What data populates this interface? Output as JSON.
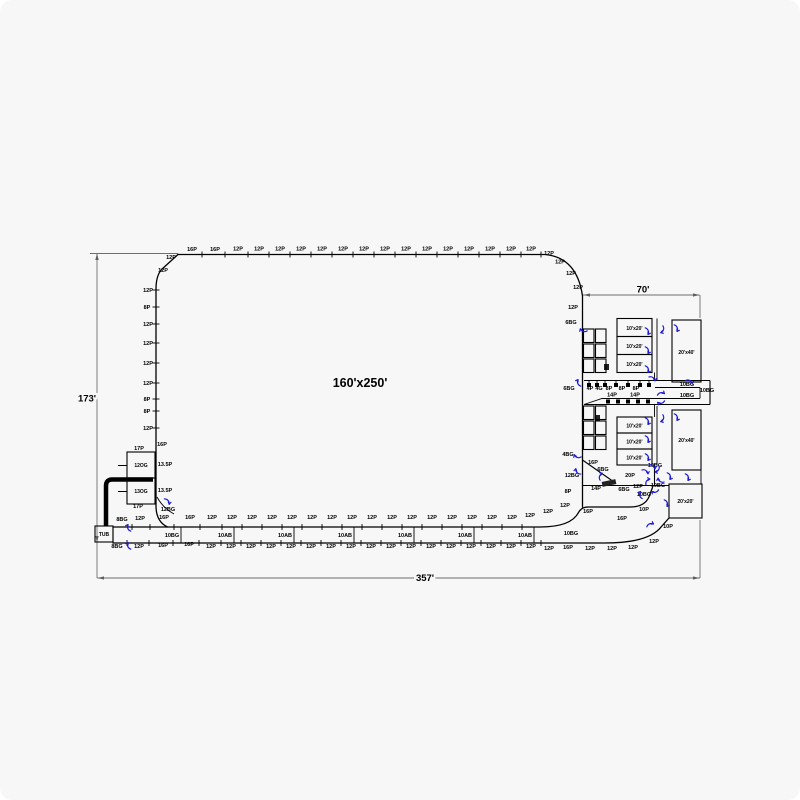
{
  "drawing": {
    "area_label": "160'x250'",
    "colors": {
      "line": "#000000",
      "dim": "#6e6e6e",
      "arrow": "#1b1bd8",
      "bg": "#f7f7f8"
    },
    "dimensions": [
      {
        "id": "overall-width",
        "label": "357'"
      },
      {
        "id": "overall-height",
        "label": "173'"
      },
      {
        "id": "wing-width",
        "label": "70'"
      }
    ],
    "rooms": [
      {
        "label": "10'x20'",
        "x": 617,
        "y": 318.5,
        "w": 35,
        "h": 18,
        "lx": 634.5,
        "ly": 330
      },
      {
        "label": "10'x20'",
        "x": 617,
        "y": 336.5,
        "w": 35,
        "h": 18,
        "lx": 634.5,
        "ly": 348
      },
      {
        "label": "10'x20'",
        "x": 617,
        "y": 354.5,
        "w": 35,
        "h": 18,
        "lx": 634.5,
        "ly": 366
      },
      {
        "label": "20'x40'",
        "x": 672,
        "y": 320,
        "w": 29,
        "h": 62,
        "lx": 686.5,
        "ly": 354
      },
      {
        "label": "10'x20'",
        "x": 617,
        "y": 417,
        "w": 35,
        "h": 16,
        "lx": 634.5,
        "ly": 427.5
      },
      {
        "label": "10'x20'",
        "x": 617,
        "y": 433,
        "w": 35,
        "h": 16,
        "lx": 634.5,
        "ly": 443.5
      },
      {
        "label": "10'x20'",
        "x": 617,
        "y": 449,
        "w": 35,
        "h": 16,
        "lx": 634.5,
        "ly": 459.5
      },
      {
        "label": "20'x40'",
        "x": 672,
        "y": 410,
        "w": 29,
        "h": 60,
        "lx": 686.5,
        "ly": 442
      },
      {
        "label": "20'x20'",
        "x": 669,
        "y": 484,
        "w": 33,
        "h": 34,
        "lx": 685.5,
        "ly": 503
      },
      {
        "label": "12OG",
        "x": 127,
        "y": 452,
        "w": 28,
        "h": 26,
        "lx": 141,
        "ly": 467
      },
      {
        "label": "13OG",
        "x": 127,
        "y": 478,
        "w": 28,
        "h": 26,
        "lx": 141,
        "ly": 493
      },
      {
        "label": "TUB",
        "x": 95,
        "y": 526,
        "w": 18,
        "h": 16,
        "lx": 104,
        "ly": 536
      }
    ],
    "ladders": [
      {
        "x": 583.5,
        "y": 329,
        "cols": 2,
        "rows": 3,
        "cw": 10.5,
        "ch": 13.5,
        "g": 1.5
      },
      {
        "x": 583.5,
        "y": 406,
        "cols": 2,
        "rows": 3,
        "cw": 10.5,
        "ch": 13.5,
        "g": 1.5
      }
    ],
    "combs": {
      "row1": [
        589,
        597,
        605,
        616,
        628,
        640,
        649
      ],
      "row2": [
        608,
        618,
        628,
        638,
        648
      ]
    },
    "label_groups": [
      {
        "name": "top-edge",
        "tick": "v",
        "ty": 254.5,
        "items": [
          [
            "16P",
            192,
            251
          ],
          [
            "16P",
            215,
            251
          ],
          [
            "12P",
            238,
            250.5
          ],
          [
            "12P",
            259,
            250.5
          ],
          [
            "12P",
            280,
            250.5
          ],
          [
            "12P",
            301,
            250.5
          ],
          [
            "12P",
            322,
            250.5
          ],
          [
            "12P",
            343,
            250.5
          ],
          [
            "12P",
            364,
            250.5
          ],
          [
            "12P",
            385,
            250.5
          ],
          [
            "12P",
            406,
            250.5
          ],
          [
            "12P",
            427,
            250.5
          ],
          [
            "12P",
            448,
            250.5
          ],
          [
            "12P",
            469,
            250.5
          ],
          [
            "12P",
            490,
            250.5
          ],
          [
            "12P",
            511,
            250.5
          ],
          [
            "12P",
            531,
            250.5
          ]
        ]
      },
      {
        "name": "corner",
        "tick": null,
        "items": [
          [
            "12P",
            171,
            259
          ],
          [
            "12P",
            549,
            255
          ],
          [
            "12P",
            560,
            263.5
          ],
          [
            "12P",
            571,
            275
          ],
          [
            "12P",
            578,
            289
          ],
          [
            "12P",
            163,
            272
          ]
        ]
      },
      {
        "name": "left-edge",
        "tick": "h",
        "items": [
          [
            "12P",
            148,
            292
          ],
          [
            "8P",
            147,
            309
          ],
          [
            "12P",
            148,
            326
          ],
          [
            "12P",
            148,
            345
          ],
          [
            "12P",
            148,
            365
          ],
          [
            "12P",
            148,
            385
          ],
          [
            "8P",
            147,
            401
          ],
          [
            "8P",
            147,
            413
          ],
          [
            "12P",
            148,
            430
          ]
        ]
      },
      {
        "name": "deck-top-row",
        "tick": "v",
        "ty": 527,
        "items": [
          [
            "8BG",
            122,
            521
          ],
          [
            "12P",
            140,
            520
          ],
          [
            "16P",
            164,
            519
          ],
          [
            "16P",
            190,
            519
          ],
          [
            "12P",
            212,
            519
          ],
          [
            "12P",
            232,
            519
          ],
          [
            "12P",
            252,
            519
          ],
          [
            "12P",
            272,
            519
          ],
          [
            "12P",
            292,
            519
          ],
          [
            "12P",
            312,
            519
          ],
          [
            "12P",
            332,
            519
          ],
          [
            "12P",
            352,
            519
          ],
          [
            "12P",
            372,
            519
          ],
          [
            "12P",
            392,
            519
          ],
          [
            "12P",
            412,
            519
          ],
          [
            "12P",
            432,
            519
          ],
          [
            "12P",
            452,
            519
          ],
          [
            "12P",
            472,
            519
          ],
          [
            "12P",
            492,
            519
          ],
          [
            "12P",
            512,
            519
          ]
        ]
      },
      {
        "name": "deck-bottom-row",
        "tick": "v",
        "ty": 543,
        "items": [
          [
            "8BG",
            117,
            548
          ],
          [
            "12P",
            139,
            548
          ],
          [
            "16P",
            163,
            547
          ],
          [
            "16P",
            189,
            546
          ],
          [
            "12P",
            211,
            548
          ],
          [
            "12P",
            231,
            548
          ],
          [
            "12P",
            251,
            548
          ],
          [
            "12P",
            271,
            548
          ],
          [
            "12P",
            291,
            548
          ],
          [
            "12P",
            311,
            548
          ],
          [
            "12P",
            331,
            548
          ],
          [
            "12P",
            351,
            548
          ],
          [
            "12P",
            371,
            548
          ],
          [
            "12P",
            391,
            548
          ],
          [
            "12P",
            411,
            548
          ],
          [
            "12P",
            431,
            548
          ],
          [
            "12P",
            451,
            548
          ],
          [
            "12P",
            471,
            548
          ],
          [
            "12P",
            491,
            548
          ],
          [
            "12P",
            511,
            548
          ],
          [
            "12P",
            531,
            548
          ]
        ]
      },
      {
        "name": "river-cell",
        "tick": null,
        "items": [
          [
            "10BG",
            172,
            537
          ],
          [
            "10AB",
            225,
            537
          ],
          [
            "10AB",
            285,
            537
          ],
          [
            "10AB",
            345,
            537
          ],
          [
            "10AB",
            405,
            537
          ],
          [
            "10AB",
            465,
            537
          ],
          [
            "10AB",
            525,
            537
          ],
          [
            "10BG",
            571,
            535
          ]
        ]
      },
      {
        "name": "inner-curve",
        "tick": null,
        "items": [
          [
            "12P",
            530,
            517
          ],
          [
            "12P",
            548,
            513
          ],
          [
            "12P",
            565,
            507
          ],
          [
            "16P",
            588,
            513
          ],
          [
            "16P",
            622,
            520
          ],
          [
            "10P",
            644,
            511
          ]
        ]
      },
      {
        "name": "outer-curve",
        "tick": null,
        "items": [
          [
            "12P",
            549,
            550
          ],
          [
            "16P",
            568,
            549
          ],
          [
            "12P",
            590,
            550
          ],
          [
            "12P",
            612,
            550
          ],
          [
            "12P",
            633,
            549
          ],
          [
            "12P",
            654,
            543
          ],
          [
            "10P",
            668,
            528
          ]
        ]
      },
      {
        "name": "right-area",
        "tick": null,
        "items": [
          [
            "12P",
            573,
            309
          ],
          [
            "6BG",
            571,
            324
          ],
          [
            "6BG",
            569,
            390
          ],
          [
            "10BG",
            687,
            386
          ],
          [
            "10BG",
            687,
            397
          ],
          [
            "10BG",
            707,
            392
          ],
          [
            "4BG",
            568,
            456
          ],
          [
            "16P",
            593,
            464
          ],
          [
            "12BG",
            572,
            477
          ],
          [
            "6BG",
            603,
            471
          ],
          [
            "20P",
            630,
            477
          ],
          [
            "8P",
            568,
            493
          ],
          [
            "14P",
            596,
            490
          ],
          [
            "6BG",
            624,
            491
          ],
          [
            "12P",
            638,
            488
          ],
          [
            "10BG",
            644,
            496
          ],
          [
            "10BG",
            655,
            467
          ],
          [
            "10BG",
            658,
            487
          ]
        ]
      },
      {
        "name": "left-structure",
        "tick": null,
        "items": [
          [
            "17P",
            139,
            450
          ],
          [
            "16P",
            162,
            446
          ],
          [
            "13.5P",
            165,
            466
          ],
          [
            "13.5P",
            165,
            492
          ],
          [
            "17P",
            138,
            508
          ],
          [
            "12BG",
            168,
            511
          ]
        ]
      },
      {
        "name": "comb-row1",
        "tick": null,
        "fs": 4,
        "items": [
          [
            "4P",
            590,
            390
          ],
          [
            "4G",
            599,
            390
          ],
          [
            "8P",
            609,
            390
          ],
          [
            "8P",
            622,
            390
          ],
          [
            "8P",
            636,
            390
          ]
        ]
      },
      {
        "name": "comb-row2",
        "tick": null,
        "fs": 4,
        "items": [
          [
            "14P",
            612,
            396.5
          ],
          [
            "14P",
            635,
            396.5
          ]
        ]
      }
    ],
    "arrows": [
      [
        583,
        331,
        210
      ],
      [
        578,
        383,
        260
      ],
      [
        648,
        331,
        80
      ],
      [
        663,
        330,
        120
      ],
      [
        677,
        328,
        80
      ],
      [
        648,
        350,
        80
      ],
      [
        648,
        369,
        80
      ],
      [
        653,
        378,
        45
      ],
      [
        661,
        393,
        0
      ],
      [
        690,
        381,
        40
      ],
      [
        661,
        403,
        180
      ],
      [
        648,
        421,
        80
      ],
      [
        663,
        419,
        120
      ],
      [
        677,
        417,
        80
      ],
      [
        648,
        439,
        80
      ],
      [
        648,
        457,
        80
      ],
      [
        653,
        466,
        45
      ],
      [
        577,
        457,
        210
      ],
      [
        577,
        472,
        240
      ],
      [
        600,
        476,
        300
      ],
      [
        646,
        471,
        45
      ],
      [
        658,
        470,
        135
      ],
      [
        647,
        481,
        315
      ],
      [
        660,
        481,
        225
      ],
      [
        670,
        476,
        80
      ],
      [
        688,
        477,
        80
      ],
      [
        655,
        492,
        180
      ],
      [
        640,
        495,
        270
      ],
      [
        667,
        503,
        80
      ],
      [
        650,
        524,
        350
      ],
      [
        128,
        528,
        260
      ],
      [
        128,
        546,
        260
      ],
      [
        168,
        501,
        60
      ]
    ]
  }
}
